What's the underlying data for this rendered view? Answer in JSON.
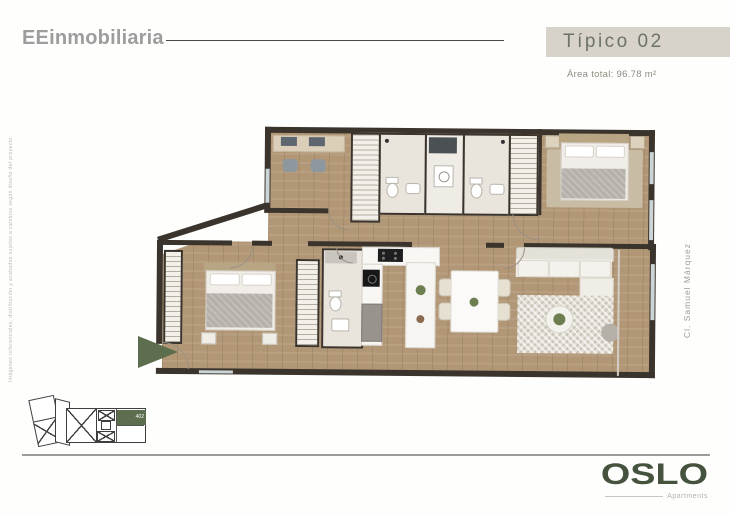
{
  "header": {
    "brand": "EEinmobiliaria",
    "unit_title": "Típico 02",
    "area_total": "Área total: 96.78 m²"
  },
  "disclaimers": {
    "left_vertical": "Imágenes referenciales, distribución y acabados sujetas a cambios según diseño del proyecto.",
    "street_right": "Cl. Samuel Márquez"
  },
  "keyplan": {
    "unit_number": "402"
  },
  "brand_footer": {
    "name": "OSLO",
    "tagline": "Apartments"
  },
  "colors": {
    "accent_green": "#5d6e4e",
    "banner_bg": "#d7d3ca",
    "banner_text": "#6e7366",
    "brand_gray": "#9d9d9d",
    "oslo_green": "#45523d",
    "wall": "#3a342c",
    "wood_floor": "#b29776",
    "bath_floor": "#eae5dc"
  }
}
